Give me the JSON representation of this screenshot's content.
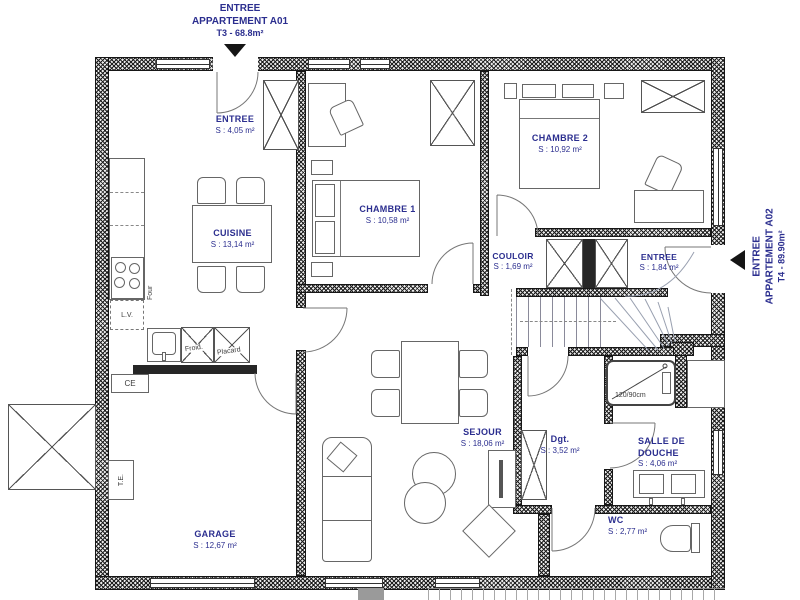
{
  "header_top": {
    "line1": "ENTREE",
    "line2": "APPARTEMENT A01",
    "line3": "T3 - 68.8m²"
  },
  "header_right": {
    "line1": "ENTREE",
    "line2": "APPARTEMENT A02",
    "line3": "T4 - 89.90m²"
  },
  "rooms": {
    "entree_a01": {
      "name": "ENTREE",
      "area": "S : 4,05 m²"
    },
    "cuisine": {
      "name": "CUISINE",
      "area": "S : 13,14 m²"
    },
    "chambre1": {
      "name": "CHAMBRE 1",
      "area": "S : 10,58 m²"
    },
    "chambre2": {
      "name": "CHAMBRE 2",
      "area": "S : 10,92 m²"
    },
    "couloir": {
      "name": "COULOIR",
      "area": "S : 1,69 m²"
    },
    "entree_a02": {
      "name": "ENTREE",
      "area": "S : 1,84 m²"
    },
    "sejour": {
      "name": "SEJOUR",
      "area": "S : 18,06 m²"
    },
    "degagement": {
      "name": "Dgt.",
      "area": "S : 3,52 m²"
    },
    "salle_de_douche": {
      "name1": "SALLE DE",
      "name2": "DOUCHE",
      "area": "S : 4,06 m²"
    },
    "wc": {
      "name": "WC",
      "area": "S : 2,77 m²"
    },
    "garage": {
      "name": "GARAGE",
      "area": "S : 12,67 m²"
    }
  },
  "equipment": {
    "oven": "Four",
    "dishwasher": "L.V.",
    "fridge": "Froid.",
    "closet": "Placard",
    "water_heater": "CE",
    "electrical_panel": "T.E.",
    "shower_size": "120/90cm"
  },
  "colors": {
    "label": "#2b2e8f",
    "wall_hatch": "#1c1c1c",
    "line": "#666666",
    "arrow": "#151515"
  }
}
